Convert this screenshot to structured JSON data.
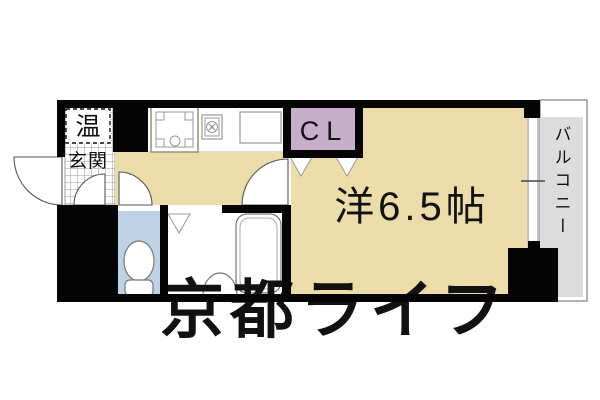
{
  "floorplan": {
    "entrance_label": "玄関",
    "water_heater_label": "温",
    "shoe_box_label": "SB",
    "closet_label": "CL",
    "main_room_label": "洋6.5帖",
    "balcony_label": "バルコニー",
    "watermark": "京都ライフ",
    "colors": {
      "room_floor": "#ecdcaa",
      "closet": "#c7aecb",
      "shoe_box": "#c7aecb",
      "toilet": "#bdd3e5",
      "balcony": "#dcdcdc",
      "wall": "#050505"
    }
  }
}
